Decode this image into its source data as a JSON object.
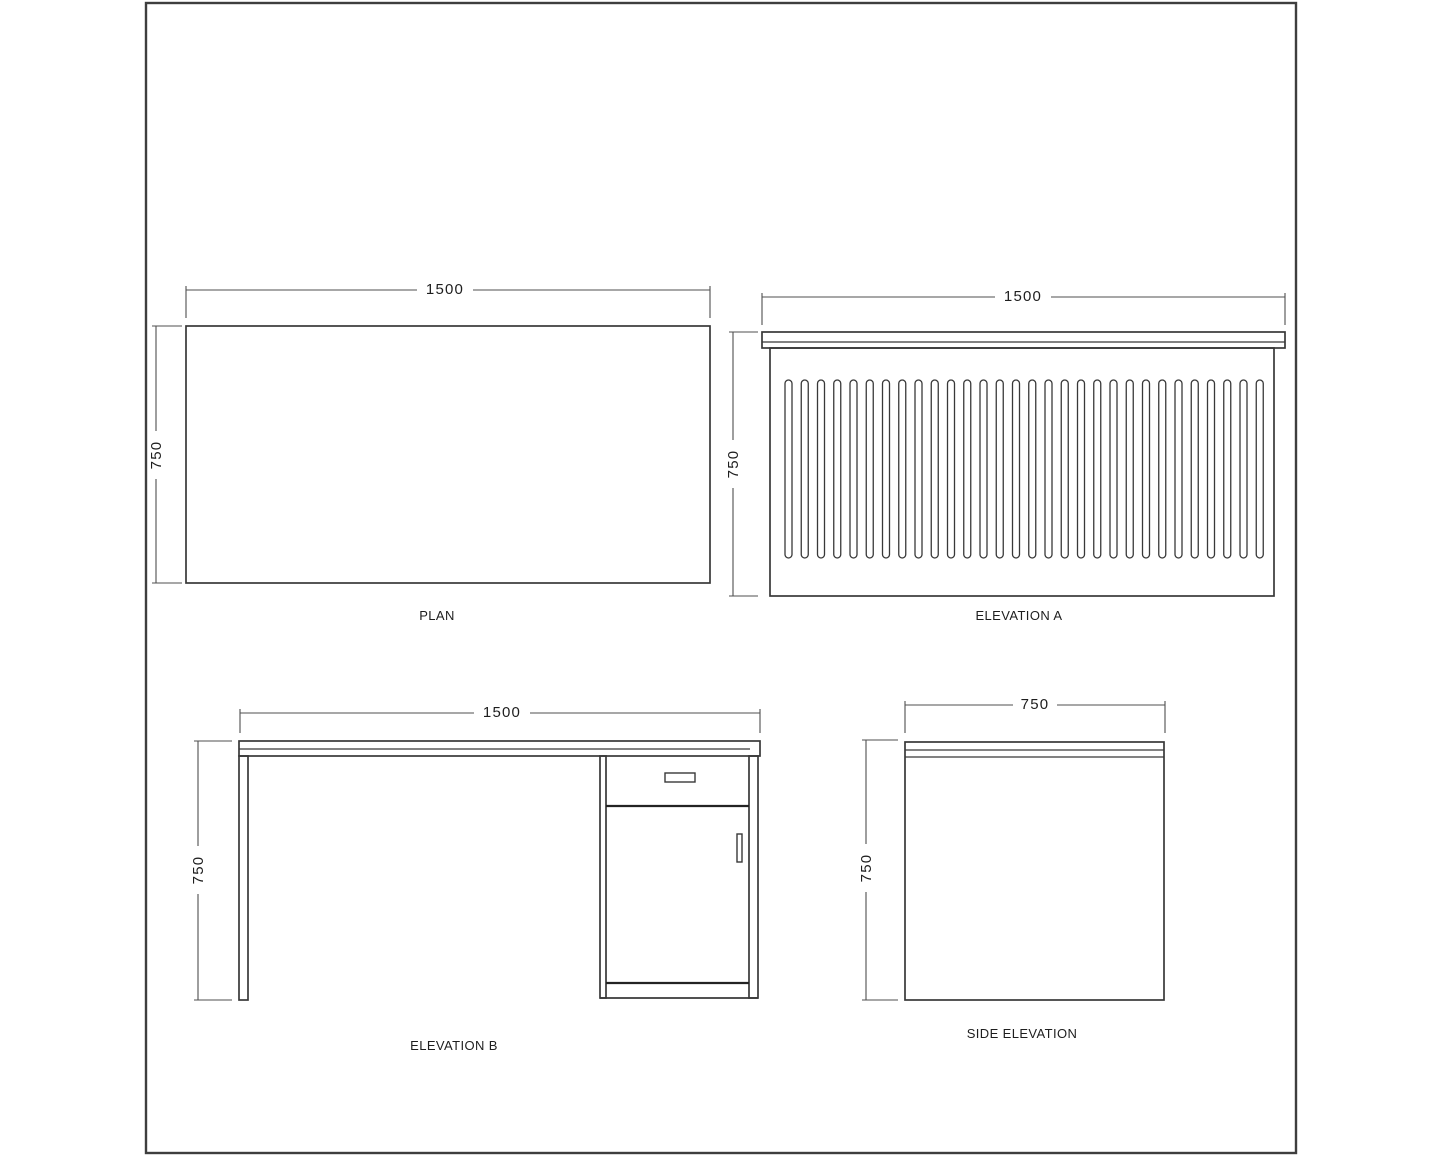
{
  "views": {
    "plan": {
      "label": "PLAN",
      "width_dim": "1500",
      "height_dim": "750"
    },
    "elevation_a": {
      "label": "ELEVATION A",
      "width_dim": "1500",
      "height_dim": "750"
    },
    "elevation_b": {
      "label": "ELEVATION B",
      "width_dim": "1500",
      "height_dim": "750"
    },
    "side_elevation": {
      "label": "SIDE ELEVATION",
      "width_dim": "750",
      "height_dim": "750"
    }
  },
  "style": {
    "background": "#ffffff",
    "border_color": "#3e3e3e",
    "object_line_color": "#383838",
    "heavy_line_color": "#232323",
    "dimension_line_color": "#4f4f4f",
    "text_color": "#1e1e1e"
  },
  "flutes": {
    "count": 30,
    "start_x": 785,
    "pitch": 16.25,
    "width": 7,
    "top_y": 380,
    "bottom_y": 558
  }
}
